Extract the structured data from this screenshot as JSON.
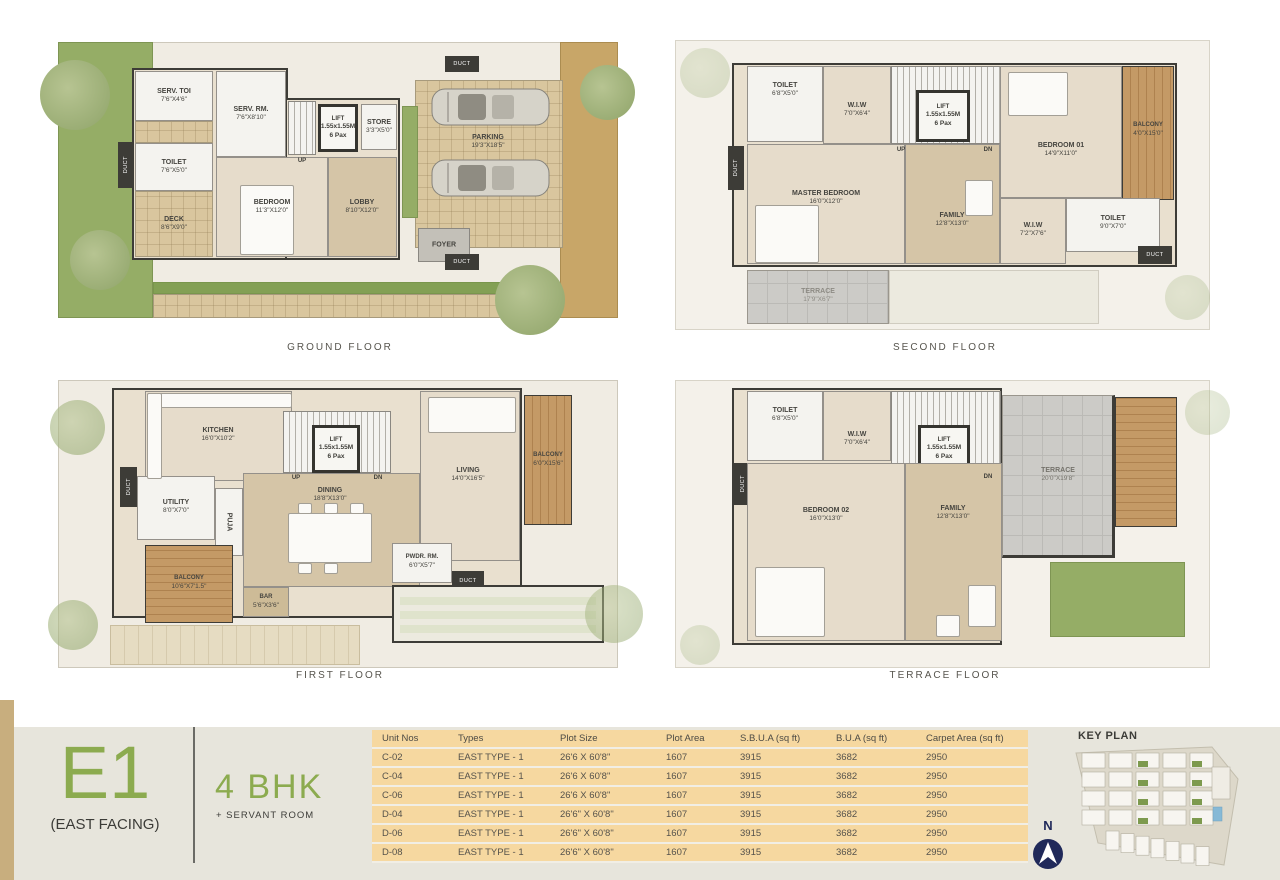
{
  "floors": {
    "ground": {
      "label": "GROUND FLOOR",
      "rooms": {
        "serv_toi": {
          "name": "SERV. TOI",
          "dims": "7'6\"X4'6\""
        },
        "toilet": {
          "name": "TOILET",
          "dims": "7'6\"X5'0\""
        },
        "deck": {
          "name": "DECK",
          "dims": "8'6\"X9'0\""
        },
        "serv_rm": {
          "name": "SERV. RM.",
          "dims": "7'6\"X8'10\""
        },
        "bedroom": {
          "name": "BEDROOM",
          "dims": "11'3\"X12'0\""
        },
        "lift": {
          "name": "LIFT",
          "dims": "1.55x1.55M",
          "cap": "6 Pax"
        },
        "store": {
          "name": "STORE",
          "dims": "3'3\"X5'0\""
        },
        "lobby": {
          "name": "LOBBY",
          "dims": "8'10\"X12'0\""
        },
        "foyer": {
          "name": "FOYER"
        },
        "parking": {
          "name": "PARKING",
          "dims": "19'3\"X18'5\""
        }
      }
    },
    "first": {
      "label": "FIRST FLOOR",
      "rooms": {
        "kitchen": {
          "name": "KITCHEN",
          "dims": "16'0\"X10'2\""
        },
        "utility": {
          "name": "UTILITY",
          "dims": "8'0\"X7'0\""
        },
        "puja": {
          "name": "PUJA"
        },
        "dining": {
          "name": "DINING",
          "dims": "18'8\"X13'0\""
        },
        "living": {
          "name": "LIVING",
          "dims": "14'0\"X16'5\""
        },
        "balcony_side": {
          "name": "BALCONY",
          "dims": "6'0\"X15'6\""
        },
        "balcony_rear": {
          "name": "BALCONY",
          "dims": "10'6\"X7'1.5\""
        },
        "bar": {
          "name": "BAR",
          "dims": "5'6\"X3'6\""
        },
        "pwdr": {
          "name": "PWDR. RM.",
          "dims": "6'0\"X5'7\""
        },
        "lift": {
          "name": "LIFT",
          "dims": "1.55x1.55M",
          "cap": "6 Pax"
        }
      }
    },
    "second": {
      "label": "SECOND FLOOR",
      "rooms": {
        "toilet_a": {
          "name": "TOILET",
          "dims": "6'8\"X5'0\""
        },
        "wiw_a": {
          "name": "W.I.W",
          "dims": "7'0\"X6'4\""
        },
        "lift": {
          "name": "LIFT",
          "dims": "1.55x1.55M",
          "cap": "6 Pax"
        },
        "master": {
          "name": "MASTER BEDROOM",
          "dims": "16'0\"X12'0\""
        },
        "family": {
          "name": "FAMILY",
          "dims": "12'8\"X13'0\""
        },
        "bedroom01": {
          "name": "BEDROOM 01",
          "dims": "14'9\"X11'0\""
        },
        "balcony": {
          "name": "BALCONY",
          "dims": "4'0\"X15'0\""
        },
        "wiw_b": {
          "name": "W.I.W",
          "dims": "7'2\"X7'6\""
        },
        "toilet_b": {
          "name": "TOILET",
          "dims": "9'0\"X7'0\""
        },
        "terrace": {
          "name": "TERRACE",
          "dims": "17'9\"X6'7\""
        }
      }
    },
    "terrace": {
      "label": "TERRACE FLOOR",
      "rooms": {
        "toilet": {
          "name": "TOILET",
          "dims": "6'8\"X5'0\""
        },
        "wiw": {
          "name": "W.I.W",
          "dims": "7'0\"X6'4\""
        },
        "lift": {
          "name": "LIFT",
          "dims": "1.55x1.55M",
          "cap": "6 Pax"
        },
        "bedroom02": {
          "name": "BEDROOM 02",
          "dims": "16'0\"X13'0\""
        },
        "family": {
          "name": "FAMILY",
          "dims": "12'8\"X13'0\""
        },
        "terrace": {
          "name": "TERRACE",
          "dims": "20'0\"X19'8\""
        }
      }
    }
  },
  "markers": {
    "up": "UP",
    "dn": "DN",
    "duct": "DUCT"
  },
  "unit": {
    "code": "E1",
    "facing": "(EAST FACING)",
    "bhk": "4 BHK",
    "sub": "+ SERVANT ROOM"
  },
  "table": {
    "headers": [
      "Unit Nos",
      "Types",
      "Plot Size",
      "Plot Area",
      "S.B.U.A (sq ft)",
      "B.U.A (sq ft)",
      "Carpet Area (sq ft)"
    ],
    "rows": [
      [
        "C-02",
        "EAST TYPE - 1",
        "26'6 X 60'8\"",
        "1607",
        "3915",
        "3682",
        "2950"
      ],
      [
        "C-04",
        "EAST TYPE - 1",
        "26'6 X 60'8\"",
        "1607",
        "3915",
        "3682",
        "2950"
      ],
      [
        "C-06",
        "EAST TYPE - 1",
        "26'6 X 60'8\"",
        "1607",
        "3915",
        "3682",
        "2950"
      ],
      [
        "D-04",
        "EAST TYPE - 1",
        "26'6\" X 60'8\"",
        "1607",
        "3915",
        "3682",
        "2950"
      ],
      [
        "D-06",
        "EAST TYPE - 1",
        "26'6\" X 60'8\"",
        "1607",
        "3915",
        "3682",
        "2950"
      ],
      [
        "D-08",
        "EAST TYPE - 1",
        "26'6\" X 60'8\"",
        "1607",
        "3915",
        "3682",
        "2950"
      ]
    ]
  },
  "key_plan": {
    "title": "KEY PLAN",
    "north": "N"
  },
  "colors": {
    "accent_green": "#8cab4f",
    "table_bg": "#f6d8a0",
    "navy": "#20295a",
    "wall": "#3d3c37"
  }
}
